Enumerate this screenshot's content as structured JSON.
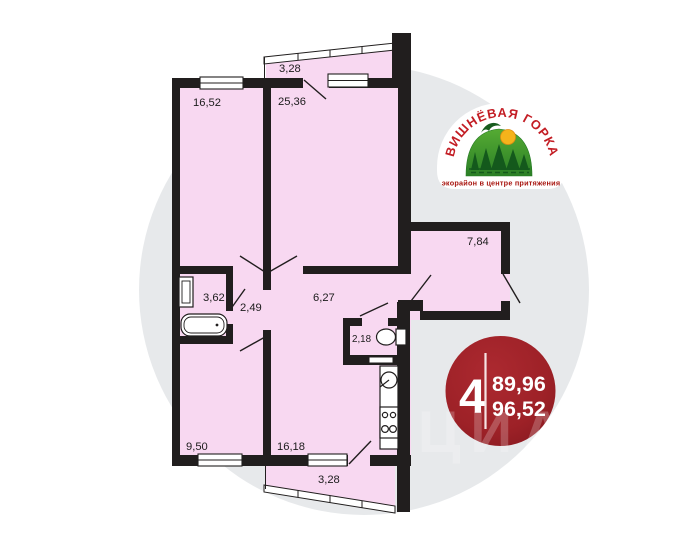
{
  "plan": {
    "rooms": [
      {
        "id": "living-16-52",
        "area": "16,52"
      },
      {
        "id": "living-25-36",
        "area": "25,36"
      },
      {
        "id": "balcony-top",
        "area": "3,28"
      },
      {
        "id": "hallway-7-84",
        "area": "7,84"
      },
      {
        "id": "bathroom-3-62",
        "area": "3,62"
      },
      {
        "id": "hall-2-49",
        "area": "2,49"
      },
      {
        "id": "corridor-6-27",
        "area": "6,27"
      },
      {
        "id": "wc-2-18",
        "area": "2,18"
      },
      {
        "id": "room-9-50",
        "area": "9,50"
      },
      {
        "id": "kitchen-16-18",
        "area": "16,18"
      },
      {
        "id": "balcony-bottom",
        "area": "3,28"
      }
    ]
  },
  "logo": {
    "title": "ВИШНЁВАЯ ГОРКА",
    "tagline": "экорайон в центре притяжения"
  },
  "badge": {
    "rooms_count": "4",
    "value_top": "89,96",
    "value_bottom": "96,52"
  },
  "watermark": {
    "text": "ЦИАН"
  },
  "colors": {
    "room_fill": "#f8d8f1",
    "wall": "#211e1e",
    "circle": "#e7e9eb",
    "badge_red": "#9d2127",
    "logo_red": "#c31d24",
    "logo_dark_red": "#a8150f",
    "logo_green": "#2b7f26",
    "sun_yellow": "#f5b31b"
  }
}
